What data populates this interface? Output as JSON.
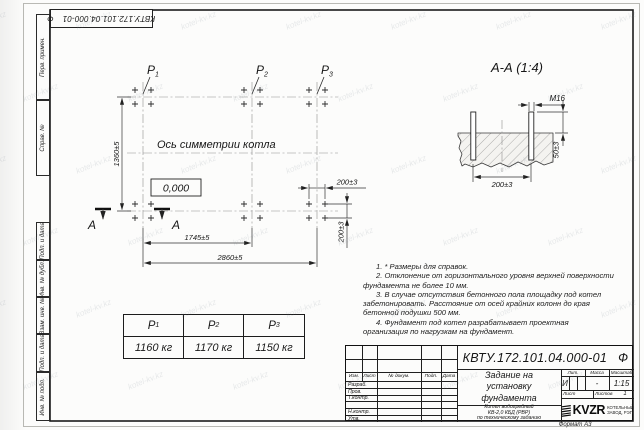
{
  "watermark": {
    "text": "kotel-kv.kz"
  },
  "doc": {
    "number": "КВТУ.172.101.04.000-01",
    "suffix": "Ф"
  },
  "margin": {
    "top_labels": [
      "Перв. примен.",
      "Справ. №"
    ],
    "bottom_labels": [
      "Подп. и дата",
      "Инв. № дубл.",
      "Взам. инв. №",
      "Подп. и дата",
      "Инв. № подл."
    ]
  },
  "plan": {
    "points": [
      {
        "base": "P",
        "sub": "1"
      },
      {
        "base": "P",
        "sub": "2"
      },
      {
        "base": "P",
        "sub": "3"
      }
    ],
    "axis_label": "Ось симметрии котла",
    "elevation_mark": "0,000",
    "section_letter": "А",
    "dim_height": "1360±5",
    "dim_p1_p2": "1745±5",
    "dim_total": "2860±5",
    "dim_bolt_x": "200±3",
    "dim_bolt_y": "200±3"
  },
  "section_view": {
    "title": "А-А (1:4)",
    "bolt_thread": "М16",
    "dim_protrusion": "50±3",
    "dim_spacing": "200±3"
  },
  "loads_table": {
    "headers": [
      {
        "base": "P",
        "sub": "1"
      },
      {
        "base": "P",
        "sub": "2"
      },
      {
        "base": "P",
        "sub": "3"
      }
    ],
    "values": [
      "1160 кг",
      "1170 кг",
      "1150 кг"
    ]
  },
  "notes": {
    "items": [
      "1. * Размеры для справок.",
      "2. Отклонение от горизонтального уровня верхней поверхности фундамента не более 10 мм.",
      "3. В случае отсутствия бетонного пола площадку под котел забетонировать. Расстояние от осей крайних колонн до края бетонной подушки 500 мм.",
      "4. Фундамент под котел разрабатывает проектная организация по нагрузкам на фундамент."
    ]
  },
  "title_block": {
    "title_lines": [
      "Задание на",
      "установку",
      "фундамента"
    ],
    "product_lines": [
      "Котел водогрейный",
      "КВ-2,0 КБД (РВР)",
      "по техническому заданию"
    ],
    "header_cols": [
      "Изм.",
      "Лист",
      "№ докум.",
      "Подп.",
      "Дата"
    ],
    "row_labels": [
      "Разраб.",
      "Пров.",
      "Т.контр.",
      "",
      "Н.контр.",
      "Утв."
    ],
    "lit_label": "Лит.",
    "mass_label": "Масса",
    "scale_label": "Масштаб",
    "lit_value": "И",
    "mass_value": "-",
    "scale_value": "1:15",
    "sheet_label": "Лист",
    "sheets_label": "Листов",
    "sheets_value": "1",
    "logo_text": "KVZR",
    "logo_caption_lines": [
      "КОТЕЛЬНЫЙ",
      "ЗАВОД, РЭП"
    ],
    "format_label": "Формат А3"
  }
}
